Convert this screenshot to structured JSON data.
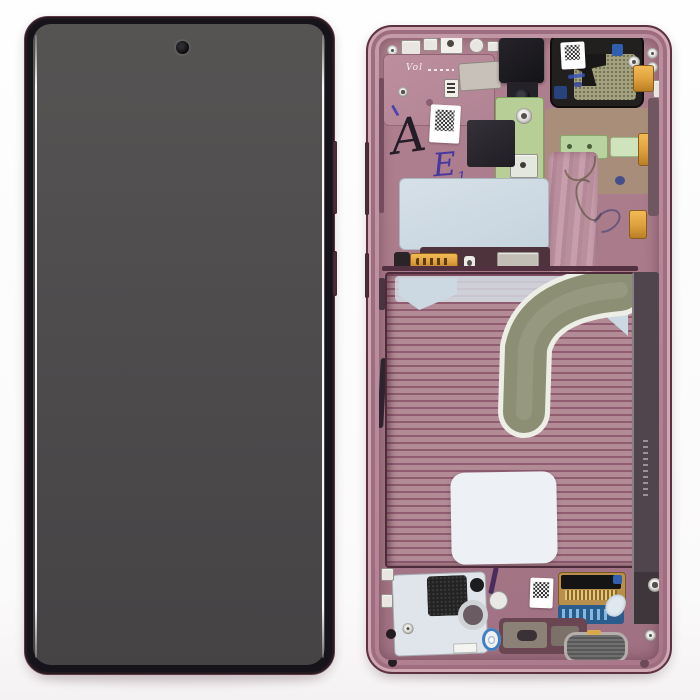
{
  "scene": {
    "handwritten_marks": {
      "letter_a": "A",
      "letter_e": "E",
      "letter_e_sub": "1",
      "script_vol": "Vol"
    },
    "palette": {
      "frame_burgundy": "#5d3142",
      "frame_pink": "#bc93a0",
      "cavity_pink": "#a87a8a",
      "screen_gray": "#4d4b4c",
      "flex_olive": "#8d8f75",
      "pcb_green": "#b7cf96",
      "gold_contact": "#dd9f3d",
      "flex_blue": "#2b5c8e",
      "plate_blue": "#cdd9e2",
      "speaker_mesh_olive": "#a3a17f",
      "ink_blue": "#4638a0",
      "ink_black": "#241c26"
    }
  }
}
